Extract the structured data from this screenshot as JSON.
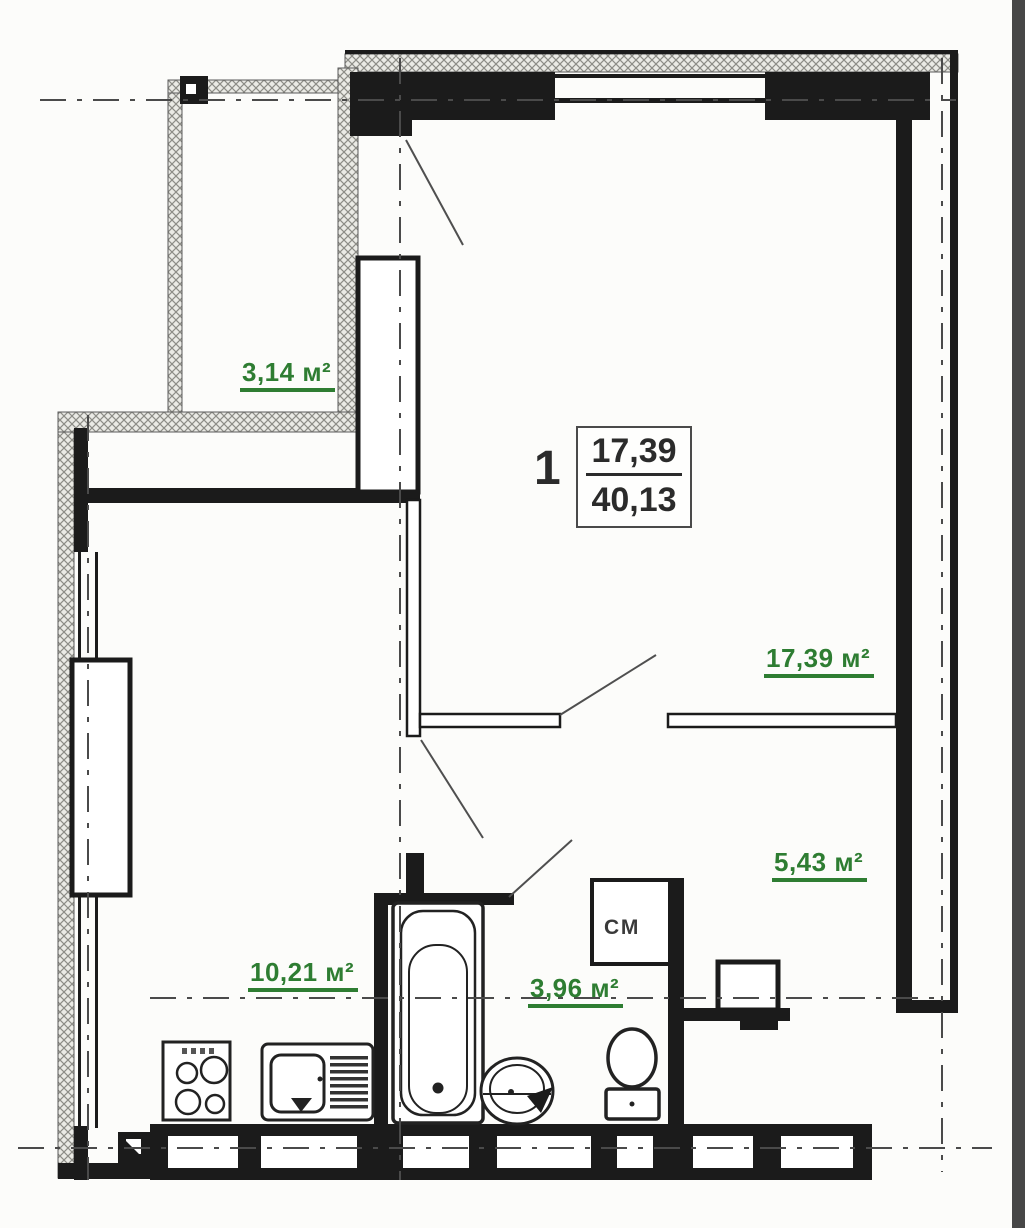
{
  "plan": {
    "apartment": {
      "number": "1",
      "living_area": "17,39",
      "total_area": "40,13"
    },
    "room_labels": {
      "loggia": "3,14 м²",
      "living_room": "17,39 м²",
      "hallway": "5,43 м²",
      "kitchen": "10,21 м²",
      "bathroom": "3,96 м²"
    },
    "annotations": {
      "washing_machine": "СМ"
    },
    "colors": {
      "area_label_green": "#2e7d32",
      "wall_black": "#1b1b1b",
      "paper": "#fcfcfa"
    }
  }
}
